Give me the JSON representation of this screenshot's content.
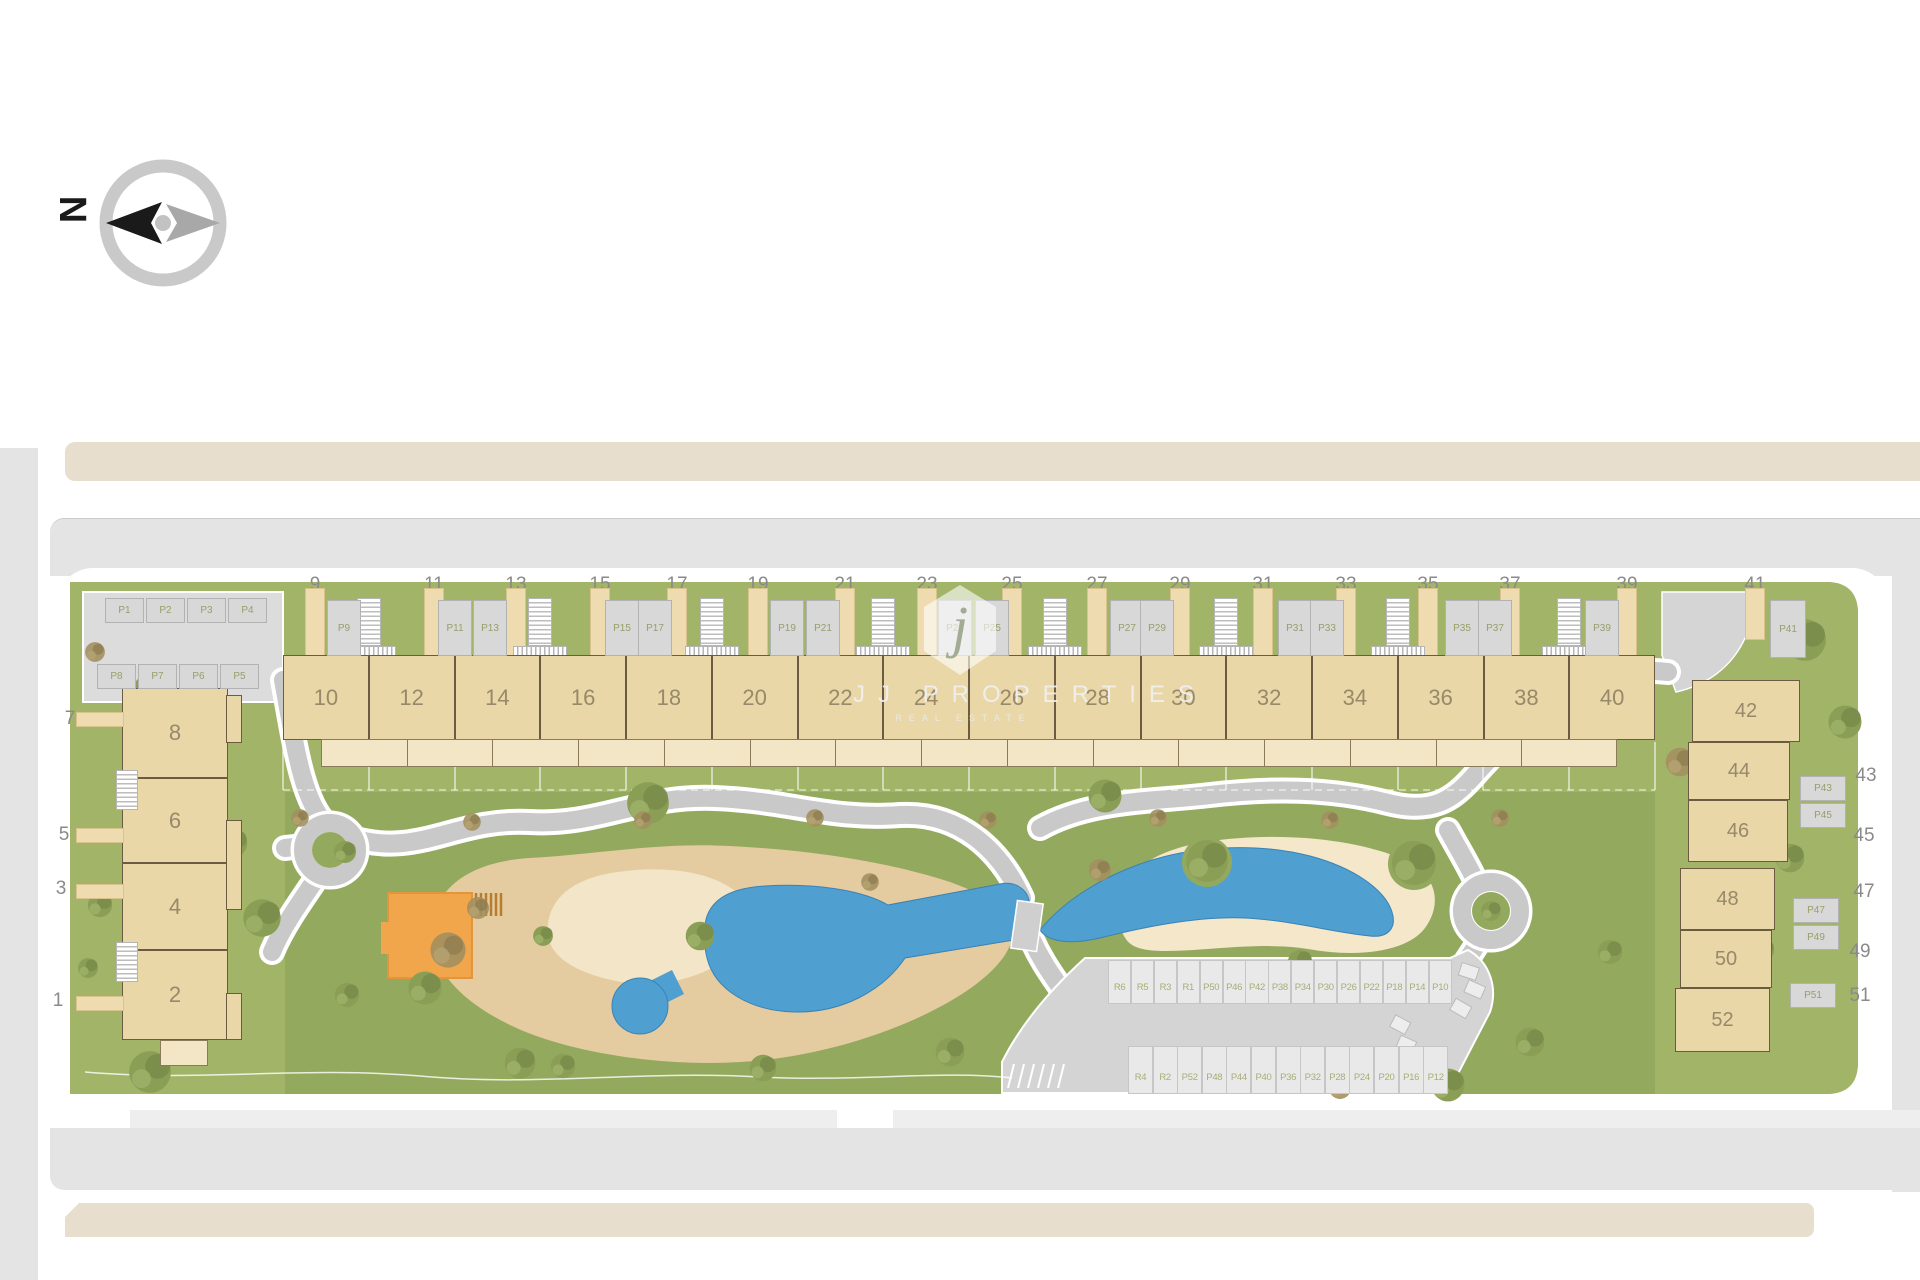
{
  "compass": {
    "north_label": "N"
  },
  "watermark": {
    "initial": "j",
    "name": "JJ PROPERTIES",
    "tagline": "REAL ESTATE"
  },
  "site_plan": {
    "top_row": {
      "street_labels": [
        "9",
        "11",
        "13",
        "15",
        "17",
        "19",
        "21",
        "23",
        "25",
        "27",
        "29",
        "31",
        "33",
        "35",
        "37",
        "39",
        "41"
      ],
      "houses": [
        "10",
        "12",
        "14",
        "16",
        "18",
        "20",
        "22",
        "24",
        "26",
        "28",
        "30",
        "32",
        "34",
        "36",
        "38",
        "40"
      ],
      "parking": [
        "P9",
        "P11",
        "P13",
        "P15",
        "P17",
        "P19",
        "P21",
        "P23",
        "P25",
        "P27",
        "P29",
        "P31",
        "P33",
        "P35",
        "P37",
        "P39"
      ]
    },
    "left_block": {
      "street_labels": [
        "7",
        "5",
        "3",
        "1"
      ],
      "houses": [
        "8",
        "6",
        "4",
        "2"
      ],
      "parking_row_upper": [
        "P1",
        "P2",
        "P3",
        "P4"
      ],
      "parking_row_lower": [
        "P8",
        "P7",
        "P6",
        "P5"
      ]
    },
    "right_block": {
      "street_labels": [
        "43",
        "45",
        "47",
        "49",
        "51"
      ],
      "houses": [
        "42",
        "44",
        "46",
        "48",
        "50",
        "52"
      ],
      "parking": [
        "P41",
        "P43",
        "P45",
        "P47",
        "P49",
        "P51"
      ]
    },
    "central_parking": {
      "row_upper": [
        "R6",
        "R5",
        "R3",
        "R1",
        "P50",
        "P46",
        "P42",
        "P38",
        "P34",
        "P30",
        "P26",
        "P22",
        "P18",
        "P14",
        "P10"
      ],
      "row_lower": [
        "R4",
        "R2",
        "P52",
        "P48",
        "P44",
        "P40",
        "P36",
        "P32",
        "P28",
        "P24",
        "P20",
        "P16",
        "P12"
      ]
    },
    "colors": {
      "lawn": "#93a95e",
      "plot_lawn": "#a2b468",
      "house": "#e9d7a8",
      "patio": "#f3e6c6",
      "pool": "#4f9fd1",
      "sand": "#e5cba0",
      "beach": "#f4e7ca",
      "road": "#e4e4e4",
      "path": "#c9c9c9",
      "playground": "#f2a64b",
      "sidewalk": "#e7decd"
    }
  }
}
